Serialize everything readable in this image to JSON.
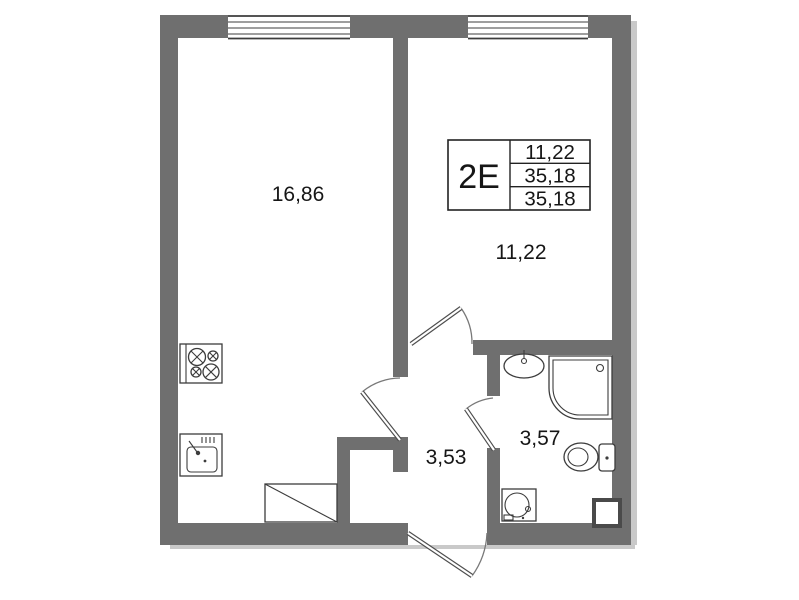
{
  "plan": {
    "title": "apartment-floor-plan",
    "legend": {
      "type": "2Е",
      "rows": [
        "11,22",
        "35,18",
        "35,18"
      ]
    },
    "rooms": {
      "living": {
        "area": "16,86"
      },
      "bedroom": {
        "area": "11,22"
      },
      "hallway": {
        "area": "3,53"
      },
      "bathroom": {
        "area": "3,57"
      }
    },
    "fixtures": [
      "stove",
      "kitchen-sink",
      "wardrobe",
      "washbasin",
      "shower",
      "toilet",
      "washing-machine",
      "vent-shaft"
    ],
    "windows": 2,
    "doors": 4,
    "colors": {
      "wall": "#6f6f6f",
      "outline": "#3c3c3c",
      "text": "#161616",
      "background": "#ffffff",
      "shadow": "#c9c9c9"
    }
  }
}
